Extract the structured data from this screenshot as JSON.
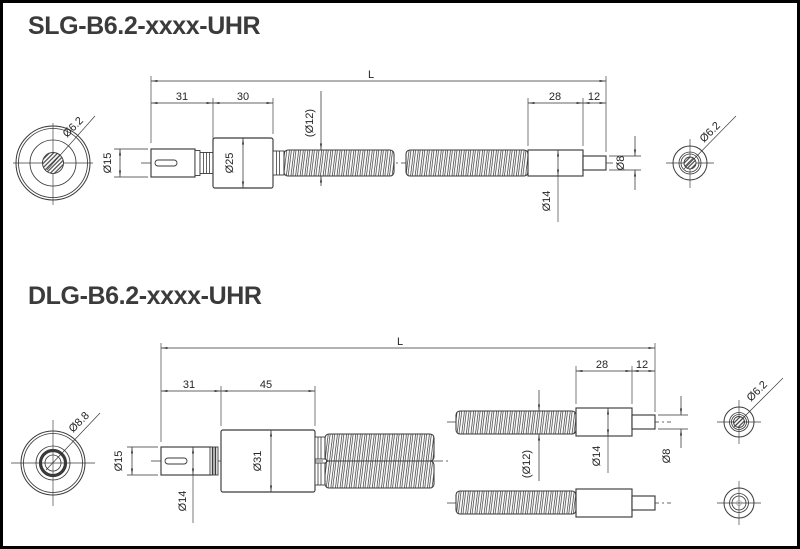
{
  "page": {
    "background": "#ffffff",
    "frame_color": "#000000",
    "line_color": "#3a3a3a",
    "title_color": "#3b3b3b"
  },
  "drawings": [
    {
      "title": "SLG-B6.2-xxxx-UHR",
      "type": "single-branch light guide",
      "labels": {
        "overall_length": "L",
        "connector_length": "31",
        "body_length": "30",
        "conduit_dia": "(Ø12)",
        "sleeve_length": "28",
        "tip_length": "12",
        "ferrule_dia": "Ø15",
        "body_dia": "Ø25",
        "sleeve_dia": "Ø14",
        "tip_dia": "Ø8",
        "input_bundle_dia": "Ø6.2",
        "output_bundle_dia": "Ø6.2"
      }
    },
    {
      "title": "DLG-B6.2-xxxx-UHR",
      "type": "dual-branch light guide",
      "labels": {
        "overall_length": "L",
        "connector_length": "31",
        "body_length": "45",
        "conduit_dia": "(Ø12)",
        "sleeve_length": "28",
        "tip_length": "12",
        "ferrule_dia": "Ø15",
        "ferrule_inner_dia": "Ø14",
        "body_dia": "Ø31",
        "sleeve_dia": "Ø14",
        "tip_dia": "Ø8",
        "input_bundle_dia": "Ø8.8",
        "output_bundle_dia": "Ø6.2"
      }
    }
  ]
}
